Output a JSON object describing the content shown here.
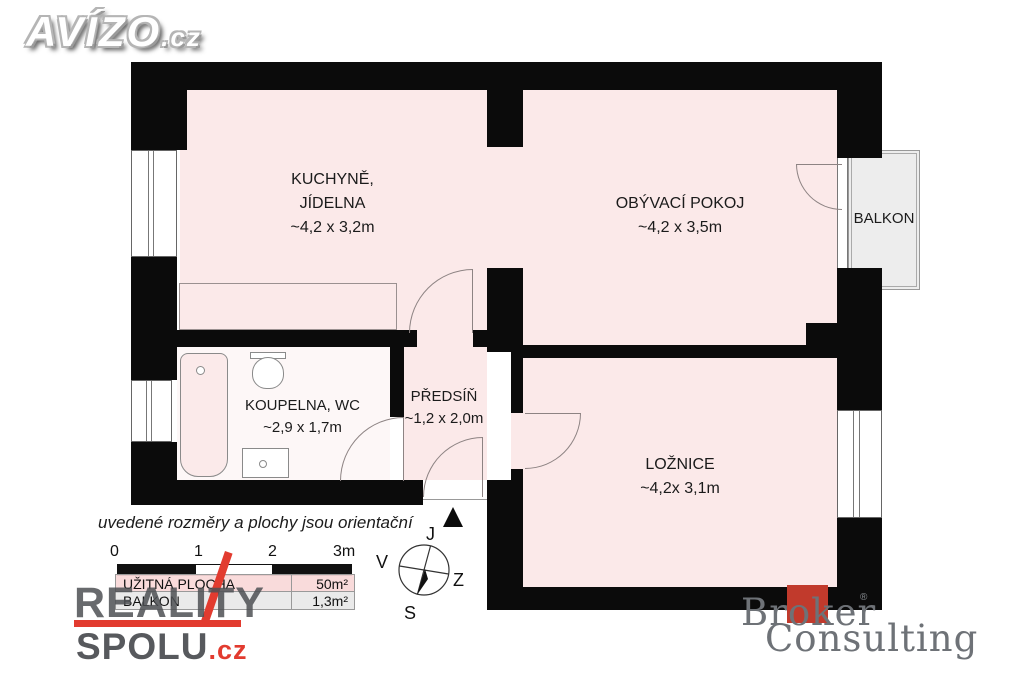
{
  "branding": {
    "avizo": {
      "name": "AVÍZO",
      "tld": ".cz"
    },
    "reality": {
      "line1": "REALITY",
      "line2": "SPOLU",
      "tld": ".cz"
    },
    "broker": {
      "word1": "Broker",
      "word2": "Consulting",
      "mark": "®"
    }
  },
  "rooms": {
    "kitchen": {
      "line1": "KUCHYNĚ,",
      "line2": "JÍDELNA",
      "dims": "~4,2 x 3,2m"
    },
    "living": {
      "line1": "OBÝVACÍ POKOJ",
      "dims": "~4,2 x 3,5m"
    },
    "bathroom": {
      "line1": "KOUPELNA, WC",
      "dims": "~2,9 x 1,7m"
    },
    "hall": {
      "line1": "PŘEDSÍŇ",
      "dims": "~1,2 x 2,0m"
    },
    "bedroom": {
      "line1": "LOŽNICE",
      "dims": "~4,2x 3,1m"
    },
    "balcony": {
      "label": "BALKON"
    }
  },
  "disclaimer": {
    "text": "uvedené rozměry a plochy jsou orientační"
  },
  "scale_bar": {
    "ticks": [
      "0",
      "1",
      "2",
      "3m"
    ]
  },
  "area_table": {
    "rows": [
      {
        "label": "UŽITNÁ PLOCHA",
        "value": "50m²"
      },
      {
        "label": "BALKON",
        "value": "1,3m²"
      }
    ]
  },
  "compass": {
    "top": "J",
    "left": "V",
    "right": "Z",
    "bottom": "S"
  },
  "colors": {
    "wall": "#0b0b0b",
    "room_fill": "#fbe9e9",
    "bathroom_fill": "#fdf7f7",
    "balcony_fill": "#ededed",
    "accent_red": "#e23b2f",
    "broker_red": "#c13a2c"
  }
}
